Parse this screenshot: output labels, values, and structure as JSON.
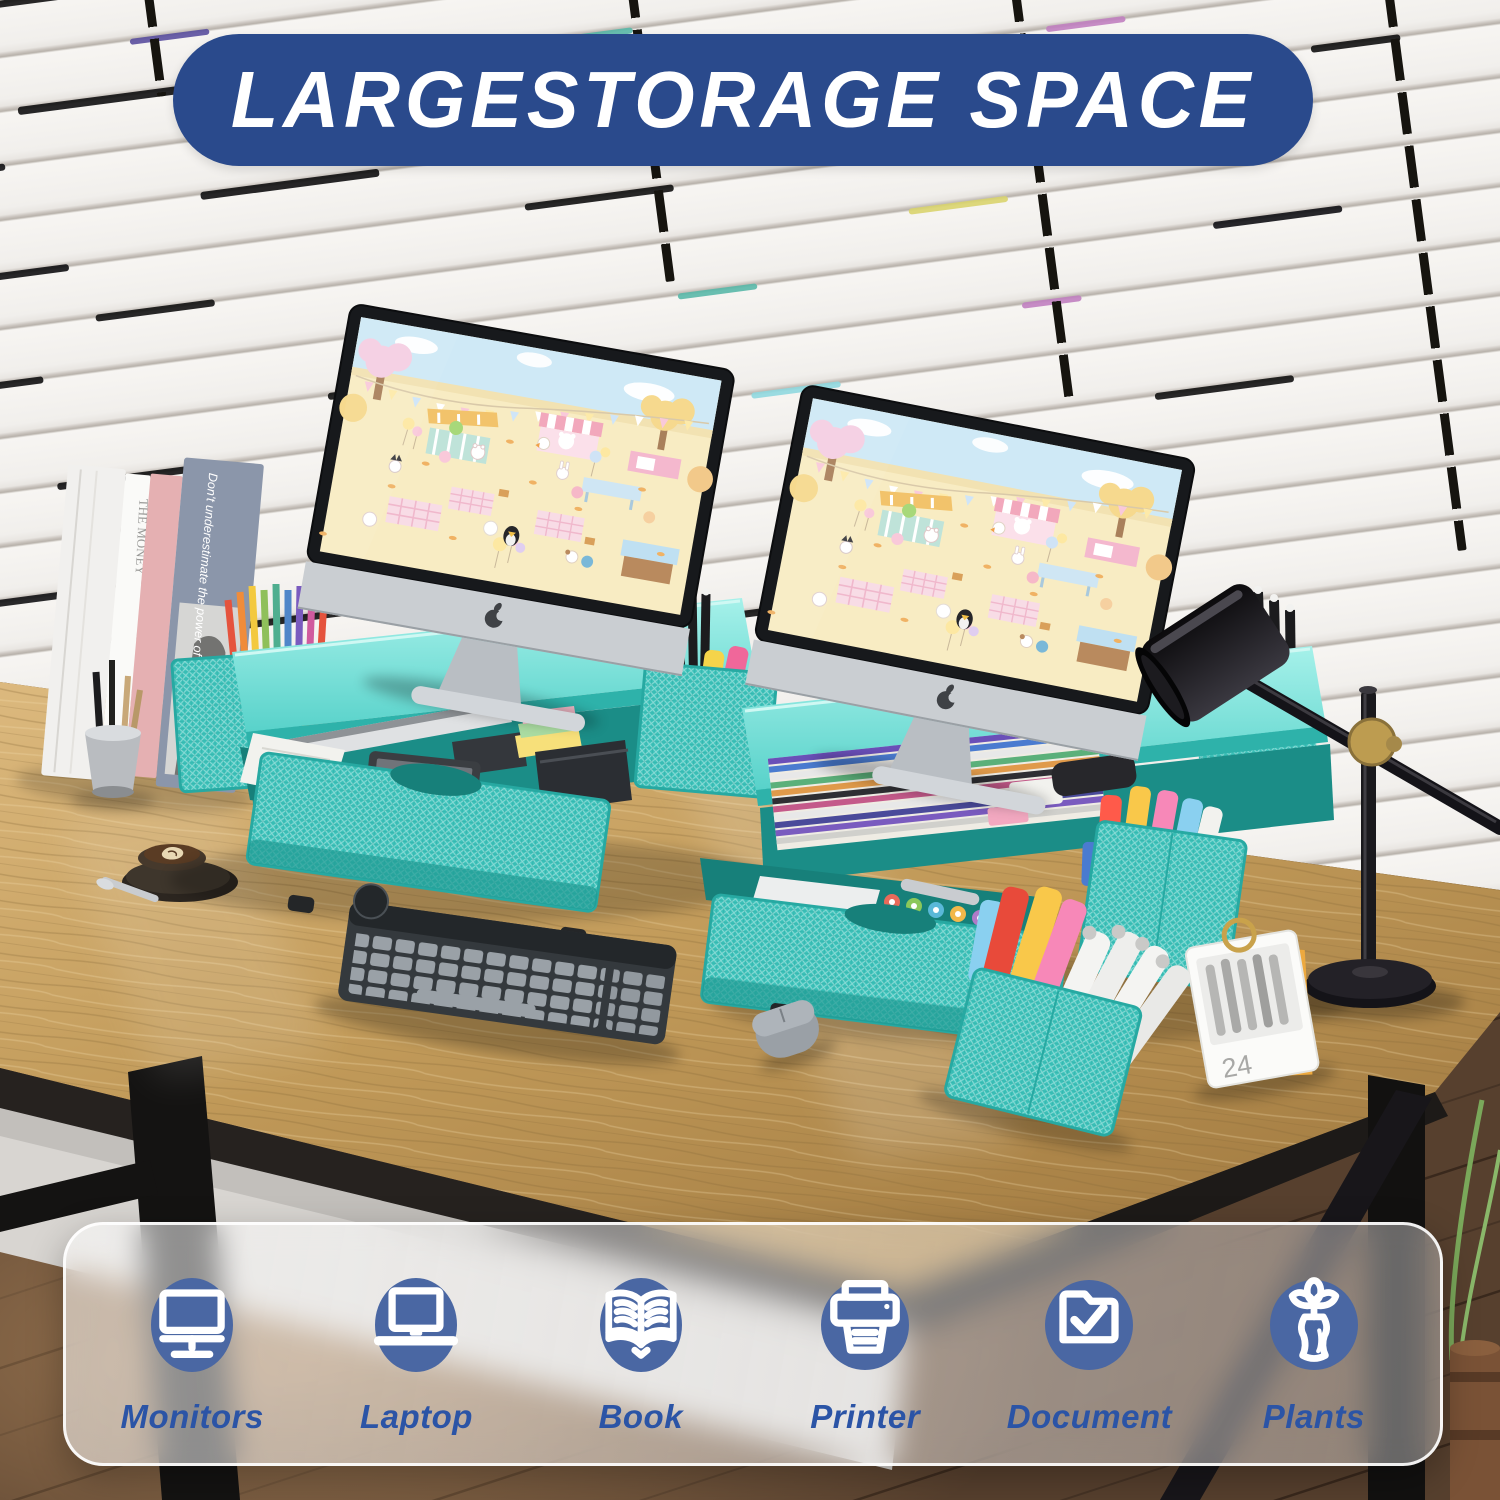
{
  "banner": {
    "text": "LARGESTORAGE SPACE",
    "bg_color": "#2a4a8c",
    "text_color": "#ffffff"
  },
  "feature_bar": {
    "label_color": "#2b54a6",
    "badge_color": "#4a67a3",
    "items": [
      {
        "label": "Monitors",
        "icon": "monitor-icon"
      },
      {
        "label": "Laptop",
        "icon": "laptop-icon"
      },
      {
        "label": "Book",
        "icon": "book-icon"
      },
      {
        "label": "Printer",
        "icon": "printer-icon"
      },
      {
        "label": "Document",
        "icon": "document-icon"
      },
      {
        "label": "Plants",
        "icon": "plants-icon"
      }
    ]
  },
  "scene": {
    "stand_color": "#45c8c0",
    "desk_calendar_day": "24",
    "book_spine_text": "THE MONEY",
    "book_cover_text": "Don't underestimate the power of the dark side"
  }
}
